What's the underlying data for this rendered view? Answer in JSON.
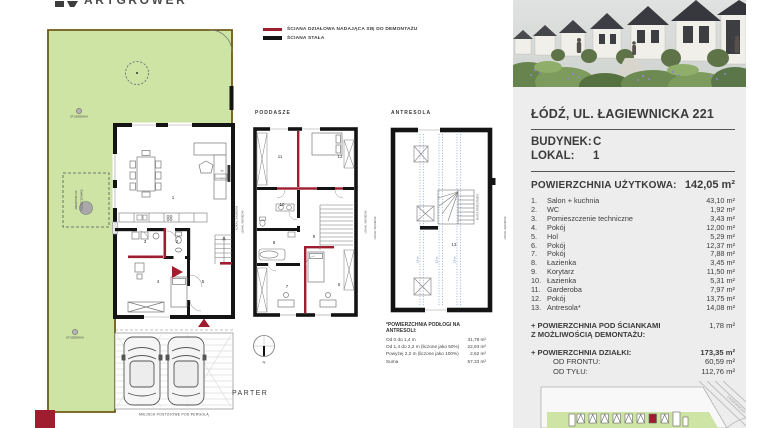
{
  "brand": {
    "logo": "ARTGROWER"
  },
  "legend": {
    "demountable": "ŚCIANA DZIAŁOWA NADAJĄCA SIĘ DO DEMONTAŻU",
    "permanent": "ŚCIANA STAŁA"
  },
  "plans": {
    "parter": {
      "label": "PARTER",
      "numbers": {
        "r1": "1",
        "r2": "2",
        "r3": "3",
        "r4": "4",
        "r5": "5"
      },
      "studzienka": "STUDZIENKA",
      "tank_line1": "ZBIORNIK NA",
      "tank_line2": "DESZCZÓWKĘ",
      "tv": "TV",
      "fireplace": "KOMINEK",
      "parking": "MIEJSCA POSTOJOWE POD PERGOLĄ",
      "neighbor": "LOKAL SĄSIEDNI"
    },
    "poddasze": {
      "label": "PODDASZE",
      "numbers": {
        "r6": "6",
        "r7": "7",
        "r8": "8",
        "r9": "9",
        "r10": "10",
        "r11": "11",
        "r12": "12"
      },
      "neighbor": "LOKAL SĄSIEDNI"
    },
    "antresola": {
      "label": "ANTRESOLA",
      "number13": "13",
      "void_label": "PUSTA PRZESTRZEŃ",
      "h1": "1,4 m",
      "h2": "2,2 m",
      "h3": "1,4 m",
      "neighbor": "LOKAL SĄSIEDNI"
    }
  },
  "compass": {
    "north": "N"
  },
  "footnote": {
    "title": "*POWIERZCHNIA PODŁOGI NA ANTRESOLI:",
    "rows": [
      {
        "label": "Od 0 do 1,4 m",
        "value": "31,78 m²"
      },
      {
        "label": "Od 1,4 do 2,2 m (liczone jako 50%)",
        "value": "22,93 m²"
      },
      {
        "label": "Powyżej 2,2 m (liczone jako 100%)",
        "value": "2,62 m²"
      },
      {
        "label": "Suma",
        "value": "57,33 m²"
      }
    ]
  },
  "panel": {
    "address": "ŁÓDŹ, UL. ŁAGIEWNICKA 221",
    "building_label": "BUDYNEK:",
    "building_value": "C",
    "unit_label": "LOKAL:",
    "unit_value": "1",
    "area_label": "POWIERZCHNIA UŻYTKOWA:",
    "area_value": "142,05 m²",
    "rooms": [
      {
        "no": "1.",
        "name": "Salon + kuchnia",
        "area": "43,10 m²"
      },
      {
        "no": "2.",
        "name": "WC",
        "area": "1,92 m²"
      },
      {
        "no": "3.",
        "name": "Pomieszczenie techniczne",
        "area": "3,43 m²"
      },
      {
        "no": "4.",
        "name": "Pokój",
        "area": "12,00 m²"
      },
      {
        "no": "5.",
        "name": "Hol",
        "area": "5,29 m²"
      },
      {
        "no": "6.",
        "name": "Pokój",
        "area": "12,37 m²"
      },
      {
        "no": "7.",
        "name": "Pokój",
        "area": "7,88 m²"
      },
      {
        "no": "8.",
        "name": "Łazienka",
        "area": "3,45 m²"
      },
      {
        "no": "9.",
        "name": "Korytarz",
        "area": "11,50 m²"
      },
      {
        "no": "10.",
        "name": "Łazienka",
        "area": "5,31 m²"
      },
      {
        "no": "11.",
        "name": "Garderoba",
        "area": "7,97 m²"
      },
      {
        "no": "12.",
        "name": "Pokój",
        "area": "13,75 m²"
      },
      {
        "no": "13.",
        "name": "Antresola*",
        "area": "14,08 m²"
      }
    ],
    "walls_extra_label1": "+ POWIERZCHNIA POD ŚCIANKAMI",
    "walls_extra_label2": "Z MOŻLIWOŚCIĄ DEMONTAŻU:",
    "walls_extra_value": "1,78 m²",
    "plot_label": "+ POWIERZCHNIA DZIAŁKI:",
    "plot_value": "173,35 m²",
    "front_label": "OD FRONTU:",
    "front_value": "60,59 m²",
    "back_label": "OD TYŁU:",
    "back_value": "112,76 m²",
    "street": "ŁAGIEWNICKA"
  },
  "colors": {
    "accent_red": "#A01D30",
    "wall_black": "#141414",
    "garden_green": "#CDE4A5",
    "garden_border": "#6F5B16",
    "panel_bg": "#EDEDED",
    "height_line_blue": "#4A74C8"
  }
}
